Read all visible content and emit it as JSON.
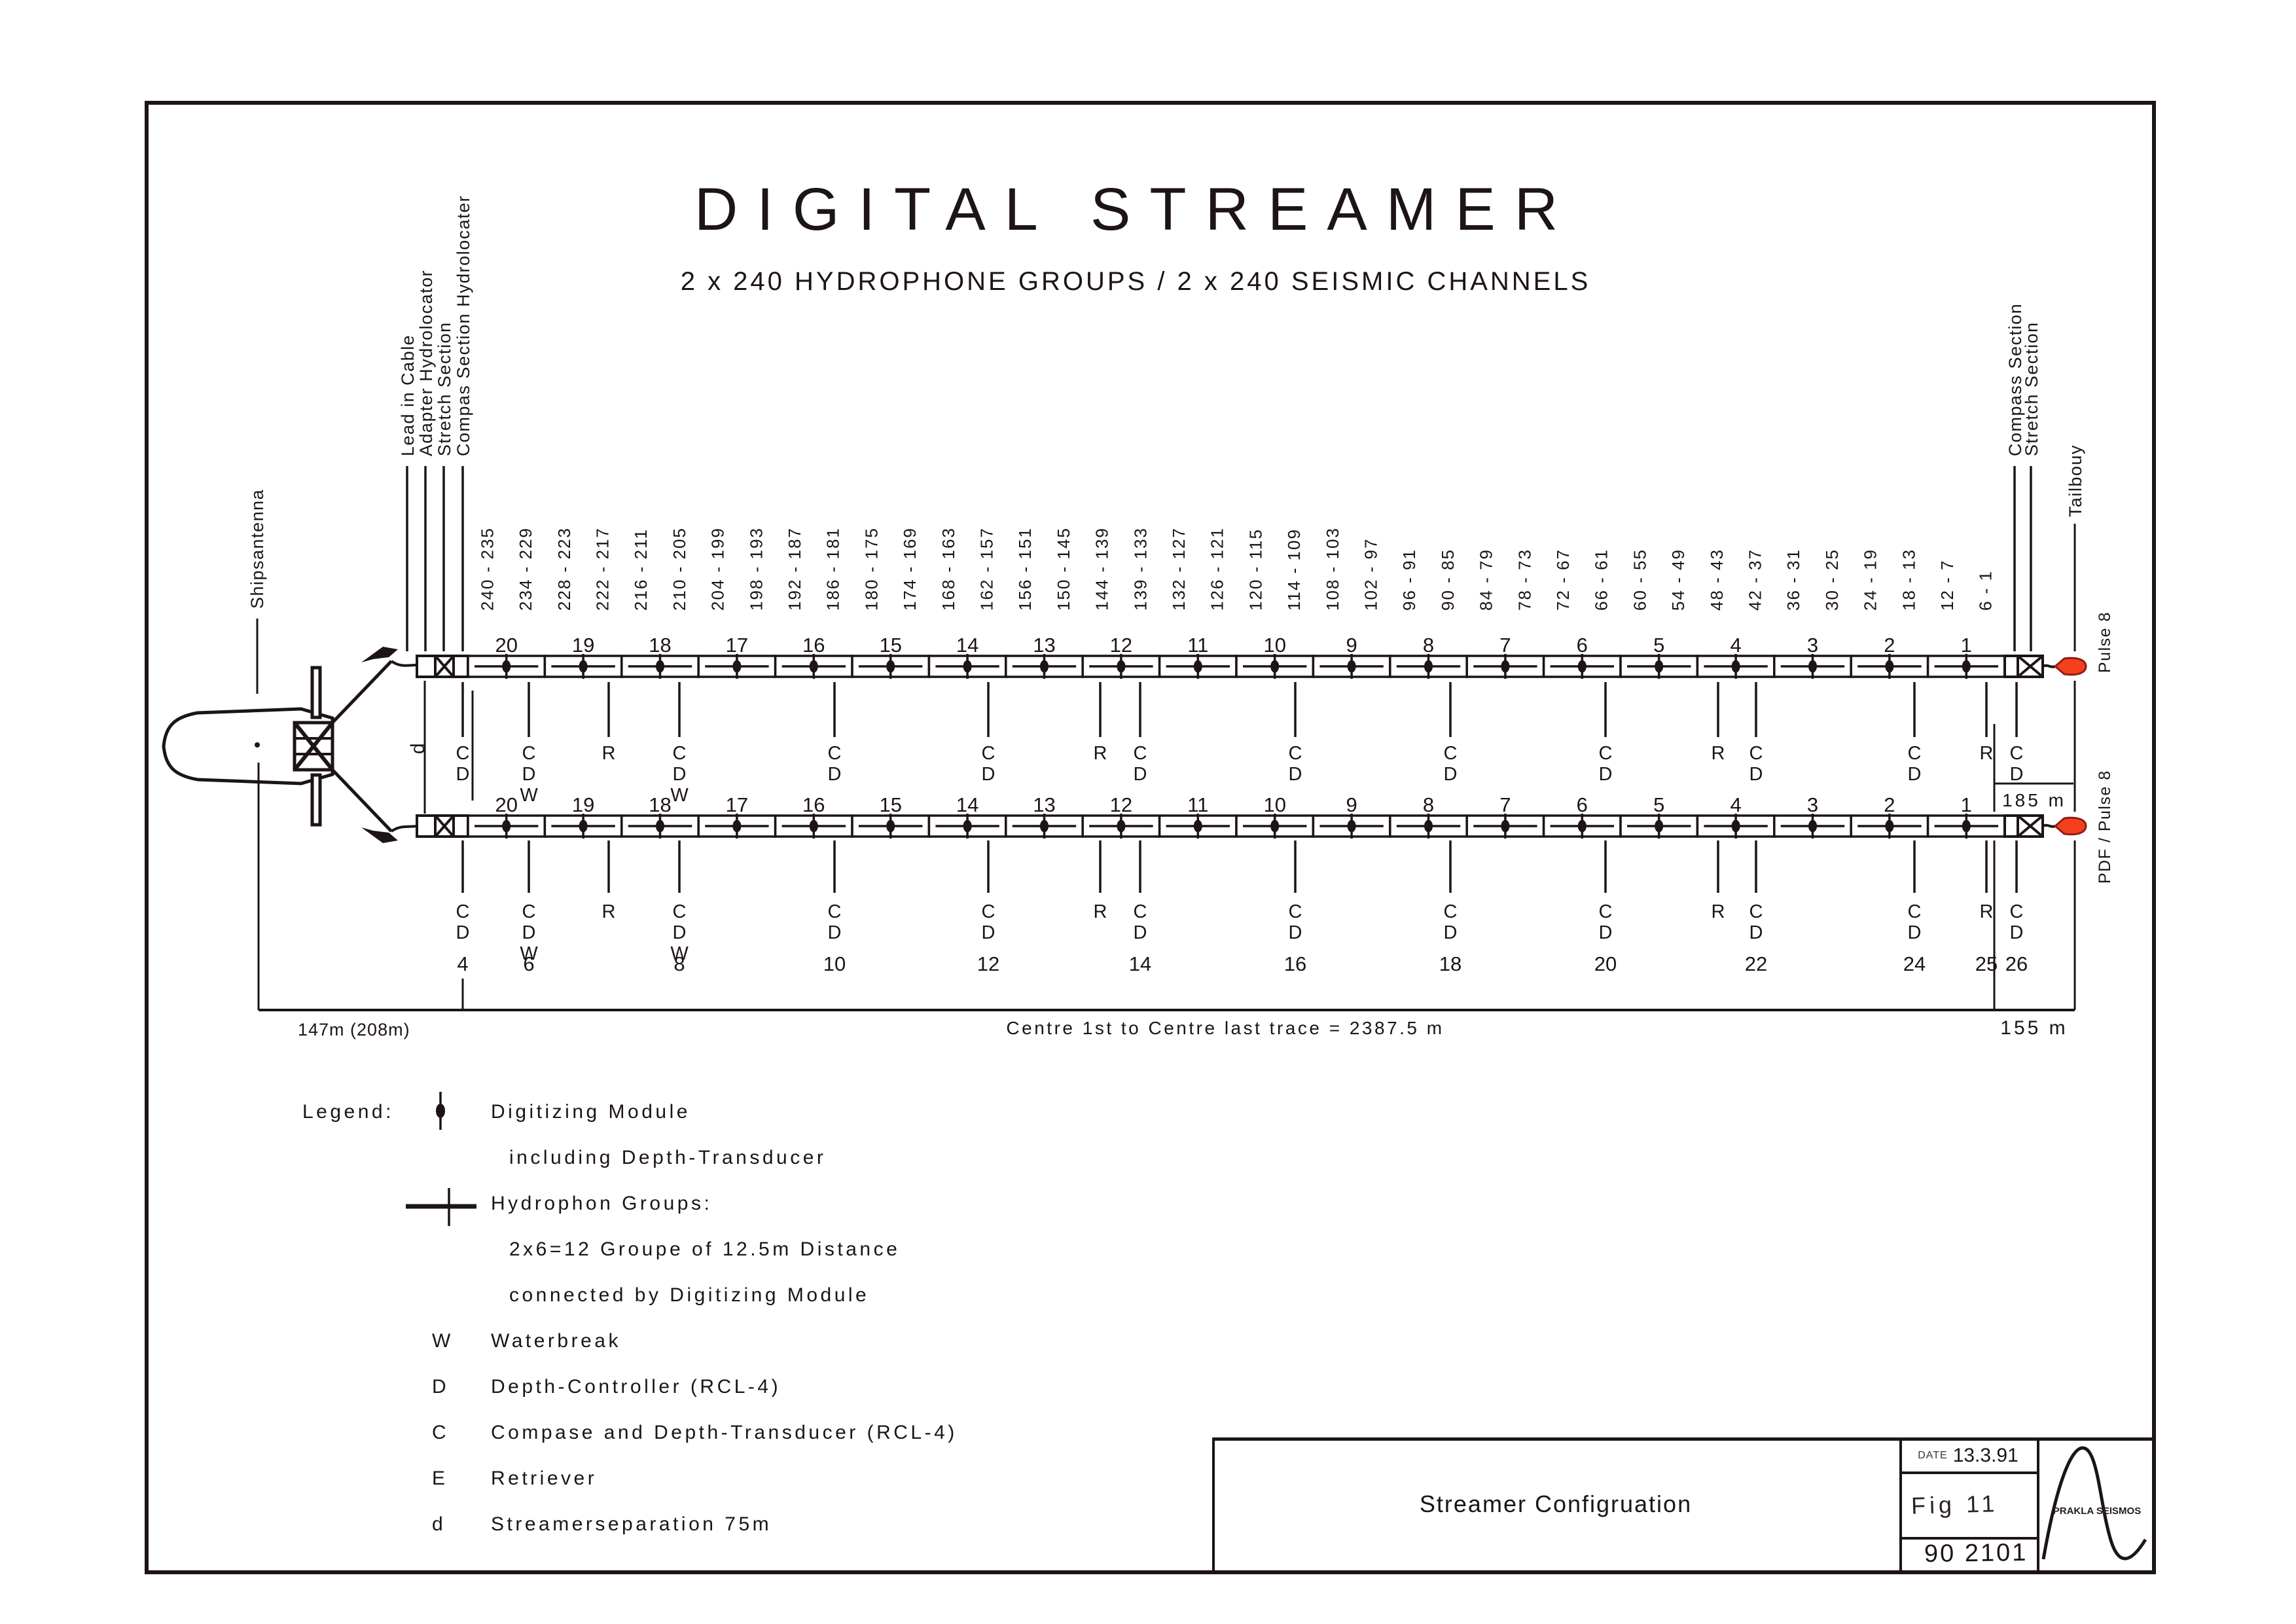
{
  "page": {
    "title": "DIGITAL STREAMER",
    "subtitle": "2 x 240 HYDROPHONE GROUPS / 2 x 240 SEISMIC CHANNELS"
  },
  "ship": {
    "antenna_label": "Shipsantenna"
  },
  "head_labels": [
    "Lead in Cable",
    "Adapter Hydrolocator",
    "Stretch Section",
    "Compas Section Hydrolocater"
  ],
  "tail_labels": {
    "compass": "Compass Section",
    "stretch": "Stretch Section",
    "tailbuoy": "Tailbouy",
    "pulse_top": "Pulse 8",
    "pulse_bottom": "PDF / Pulse 8"
  },
  "streamer": {
    "sections": [
      "20",
      "19",
      "18",
      "17",
      "16",
      "15",
      "14",
      "13",
      "12",
      "11",
      "10",
      "9",
      "8",
      "7",
      "6",
      "5",
      "4",
      "3",
      "2",
      "1"
    ],
    "channel_groups": [
      "240 - 235",
      "234 - 229",
      "228 - 223",
      "222 - 217",
      "216 - 211",
      "210 - 205",
      "204 - 199",
      "198 - 193",
      "192 - 187",
      "186 - 181",
      "180 - 175",
      "174 - 169",
      "168 - 163",
      "162 - 157",
      "156 - 151",
      "150 - 145",
      "144 - 139",
      "139 - 133",
      "132 - 127",
      "126 - 121",
      "120 - 115",
      "114 - 109",
      "108 - 103",
      "102 - 97",
      "96 - 91",
      "90 - 85",
      "84 - 79",
      "78 - 73",
      "72 - 67",
      "66 - 61",
      "60 - 55",
      "54 - 49",
      "48 - 43",
      "42 - 37",
      "36 - 31",
      "30 - 25",
      "24 - 19",
      "18 - 13",
      "12 - 7",
      "6 - 1"
    ]
  },
  "markers": [
    {
      "at": 707,
      "stack": "CD",
      "num": "4"
    },
    {
      "at": 808,
      "stack": "CDW",
      "num": "6"
    },
    {
      "at": 930,
      "stack": "R",
      "num": ""
    },
    {
      "at": 1038,
      "stack": "CDW",
      "num": "8"
    },
    {
      "at": 1275,
      "stack": "CD",
      "num": "10"
    },
    {
      "at": 1510,
      "stack": "CD",
      "num": "12"
    },
    {
      "at": 1681,
      "stack": "R",
      "num": ""
    },
    {
      "at": 1742,
      "stack": "CD",
      "num": "14"
    },
    {
      "at": 1979,
      "stack": "CD",
      "num": "16"
    },
    {
      "at": 2216,
      "stack": "CD",
      "num": "18"
    },
    {
      "at": 2453,
      "stack": "CD",
      "num": "20"
    },
    {
      "at": 2625,
      "stack": "R",
      "num": ""
    },
    {
      "at": 2683,
      "stack": "CD",
      "num": "22"
    },
    {
      "at": 2925,
      "stack": "CD",
      "num": "24"
    },
    {
      "at": 3035,
      "stack": "R",
      "num": "25"
    },
    {
      "at": 3081,
      "stack": "CD",
      "num": "26"
    }
  ],
  "separation_label": "d",
  "dimensions": {
    "left": "147m (208m)",
    "centre": "Centre 1st to Centre last trace  =  2387.5 m",
    "right": "155 m",
    "tail": "185 m"
  },
  "legend": {
    "heading": "Legend:",
    "items": [
      {
        "symbol": "digitizing-module",
        "lines": [
          "Digitizing Module",
          "including Depth-Transducer"
        ]
      },
      {
        "symbol": "hydrophone-group",
        "lines": [
          "Hydrophon Groups:",
          "2x6=12 Groupe of 12.5m Distance",
          "connected by Digitizing Module"
        ]
      },
      {
        "symbol": "W",
        "lines": [
          "Waterbreak"
        ]
      },
      {
        "symbol": "D",
        "lines": [
          "Depth-Controller (RCL-4)"
        ]
      },
      {
        "symbol": "C",
        "lines": [
          "Compase and Depth-Transducer (RCL-4)"
        ]
      },
      {
        "symbol": "E",
        "lines": [
          "Retriever"
        ]
      },
      {
        "symbol": "d",
        "lines": [
          "Streamerseparation 75m"
        ]
      }
    ]
  },
  "title_block": {
    "title": "Streamer Configruation",
    "date_label": "DATE",
    "date": "13.3.91",
    "fig": "Fig  11",
    "number": "90 2101",
    "logo": "PRAKLA SEISMOS"
  },
  "colors": {
    "ink": "#1c1416",
    "buoy_fill": "#f5401d",
    "buoy_edge": "#8a2013"
  }
}
